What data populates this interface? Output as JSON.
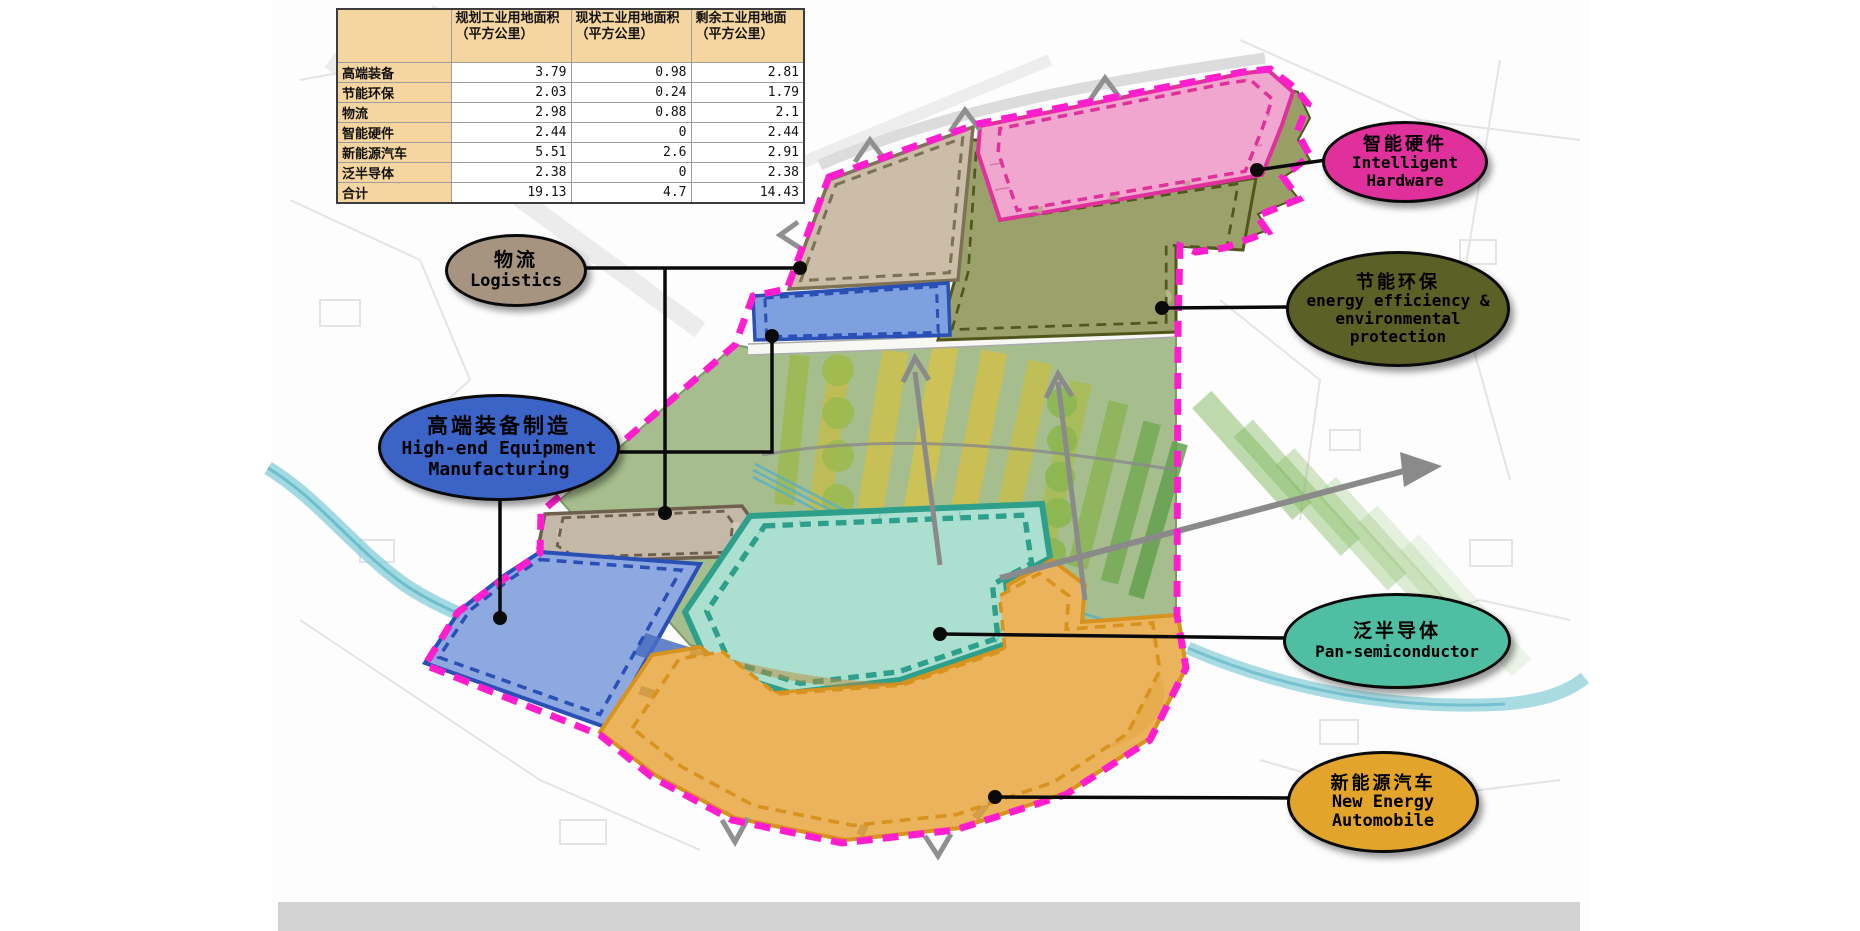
{
  "table": {
    "columns": [
      "规划工业用地面积（平方公里）",
      "现状工业用地面积（平方公里）",
      "剩余工业用地面（平方公里）"
    ],
    "rows": [
      {
        "label": "高端装备",
        "values": [
          "3.79",
          "0.98",
          "2.81"
        ]
      },
      {
        "label": "节能环保",
        "values": [
          "2.03",
          "0.24",
          "1.79"
        ]
      },
      {
        "label": "物流",
        "values": [
          "2.98",
          "0.88",
          "2.1"
        ]
      },
      {
        "label": "智能硬件",
        "values": [
          "2.44",
          "0",
          "2.44"
        ]
      },
      {
        "label": "新能源汽车",
        "values": [
          "5.51",
          "2.6",
          "2.91"
        ]
      },
      {
        "label": "泛半导体",
        "values": [
          "2.38",
          "0",
          "2.38"
        ]
      },
      {
        "label": "合计",
        "values": [
          "19.13",
          "4.7",
          "14.43"
        ]
      }
    ]
  },
  "labels": {
    "logistics": {
      "zh": "物流",
      "en": "Logistics",
      "fill": "#A79480"
    },
    "intelligent": {
      "zh": "智能硬件",
      "en": "Intelligent Hardware",
      "fill": "#DF309C"
    },
    "energy": {
      "zh": "节能环保",
      "en": "energy efficiency & environmental protection",
      "fill": "#5B6027"
    },
    "highend": {
      "zh": "高端装备制造",
      "en": "High-end Equipment Manufacturing",
      "fill": "#3C64C6"
    },
    "pansemi": {
      "zh": "泛半导体",
      "en": "Pan-semiconductor",
      "fill": "#4FBEA3"
    },
    "newenergy": {
      "zh": "新能源汽车",
      "en": "New Energy Automobile",
      "fill": "#E3A42C"
    }
  },
  "colors": {
    "boundary": "#FF1ECE",
    "connector": "#0a0a0a",
    "zones": {
      "corridor": "#A6BE8E",
      "logistics_north": "#CCBDA8",
      "intelligent_hardware": "#F0A6CE",
      "energy_env": "#9AA16A",
      "ne_area": "#98A065",
      "high_end_strip": "#7FA0DE",
      "logistics_south": "#C4B8A8",
      "high_end_main": "#8EA8E0",
      "pan_semiconductor": "#ABE0D0",
      "new_energy": "#EBB35B"
    }
  }
}
